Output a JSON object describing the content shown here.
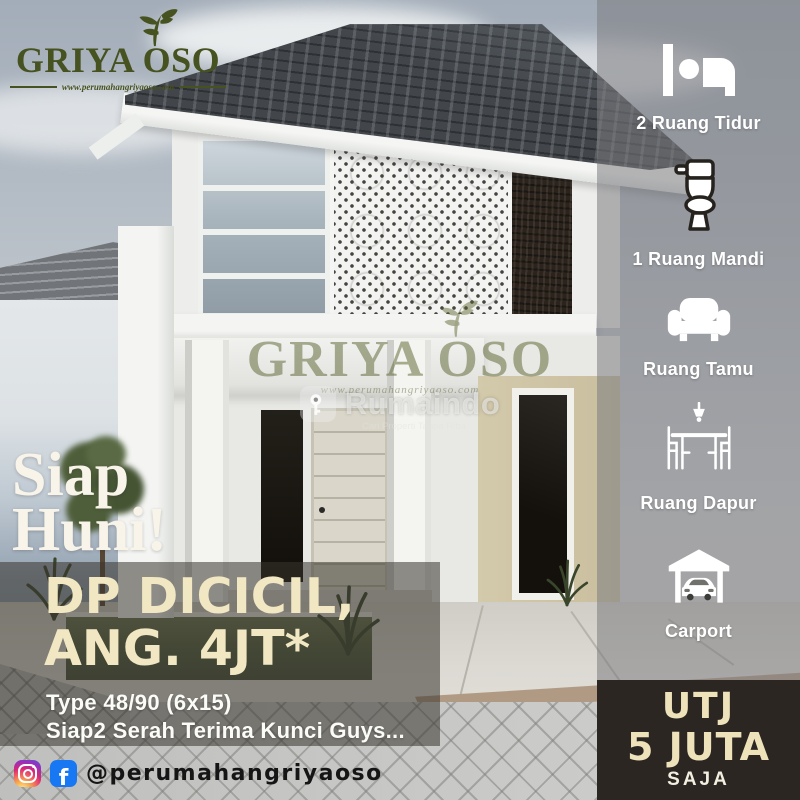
{
  "brand": {
    "name": "GRIYA OSO",
    "tagline": "www.perumahangriyaoso.com",
    "icon": "leaf-icon",
    "color": "#46521f"
  },
  "headline": {
    "line1": "Siap",
    "line2": "Huni!"
  },
  "offer": {
    "line1": "DP DICICIL,",
    "line2": "ANG. 4JT*",
    "spec": "Type 48/90 (6x15)",
    "note": "Siap2 Serah Terima Kunci Guys...",
    "accent_color": "#f1e7c2"
  },
  "features": [
    {
      "icon": "bed-icon",
      "label": "2 Ruang Tidur"
    },
    {
      "icon": "toilet-icon",
      "label": "1 Ruang Mandi"
    },
    {
      "icon": "sofa-icon",
      "label": "Ruang Tamu"
    },
    {
      "icon": "dining-table-icon",
      "label": "Ruang Dapur"
    },
    {
      "icon": "carport-icon",
      "label": "Carport"
    }
  ],
  "price_box": {
    "line1": "UTJ",
    "line2": "5 JUTA",
    "line3": "SAJA",
    "bg_color": "#2b2622",
    "text_color": "#eee2ba"
  },
  "watermark": {
    "brand": "GRIYA OSO",
    "url": "www.perumahangriyaoso.com",
    "partner": "Rumaindo",
    "partner_icon": "key-icon",
    "partner_tagline": "Cari Properti Tanpa Riba"
  },
  "social": {
    "handle": "@perumahangriyaoso",
    "icons": [
      "instagram-icon",
      "facebook-icon"
    ],
    "facebook_color": "#1877f2"
  }
}
